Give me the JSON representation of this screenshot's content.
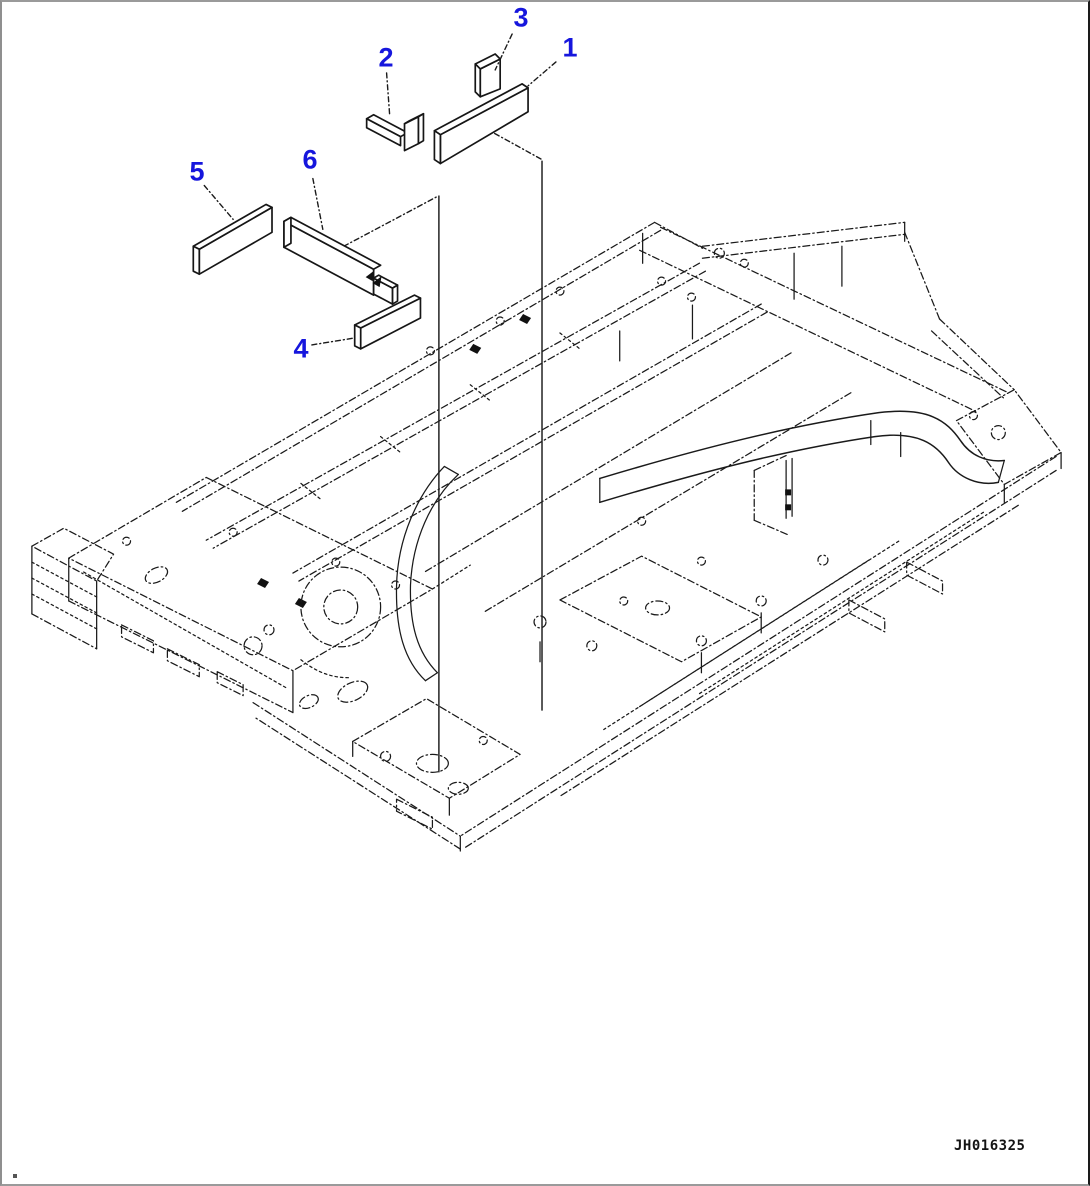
{
  "figure": {
    "drawing_code": "JH016325",
    "callouts": [
      {
        "number": "1"
      },
      {
        "number": "2"
      },
      {
        "number": "3"
      },
      {
        "number": "4"
      },
      {
        "number": "5"
      },
      {
        "number": "6"
      }
    ],
    "colors": {
      "callout": "#1616dd",
      "line_art": "#1a1a1a",
      "background": "#ffffff"
    }
  }
}
